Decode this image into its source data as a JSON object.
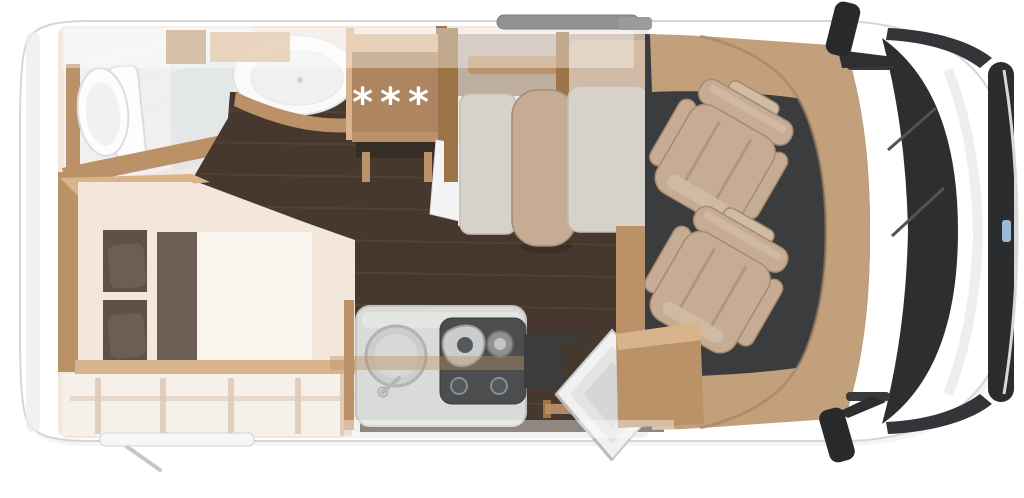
{
  "scene": {
    "background": "#ffffff"
  },
  "fridge_cabinet": {
    "freezer_symbols": "***"
  },
  "colors": {
    "page_bg": "#ffffff",
    "body_white": "#ffffff",
    "body_edge": "#d6d6d6",
    "body_inner_shadow": "#ececec",
    "interior_base": "#efe7e0",
    "floor_wood_dark": "#46382e",
    "floor_streak": "#6b5845",
    "cabinet_wood": "#bb9168",
    "cabinet_wood_light": "#d7b48c",
    "cabinet_wood_dark": "#9d7348",
    "under_cabinet_dark": "#352e27",
    "mattress_cream": "#f3e7dc",
    "blanket_white": "#faf4ee",
    "runner_taupe": "#6b5f55",
    "pillow_dark": "#5d5148",
    "pillow_light": "#6b5e54",
    "bench_gray": "#d6d2c9",
    "bench_gray_edge": "#c2beb5",
    "seat_beige": "#c6ac94",
    "seat_beige_light": "#d2bba4",
    "seat_beige_dark": "#a68a70",
    "dinette_band": "#b7a696",
    "cab_floor": "#3b3c3e",
    "dashboard_wood": "#c2a07c",
    "dashboard_wood_dark": "#a3805f",
    "glass_dark": "#2d2e30",
    "window_dark": "#333538",
    "fascia_dark": "#2b2c2e",
    "counter_gray": "#dadad8",
    "counter_edge": "#c2c2c0",
    "stove_dark": "#4b4d4f",
    "chrome": "#caccce",
    "mirror_black": "#27292b",
    "awning_gray": "#8f9193",
    "badge_blue": "#a9c9e8",
    "glass_panel": "#e2e5e7",
    "toilet_white": "#fdfdfd"
  }
}
